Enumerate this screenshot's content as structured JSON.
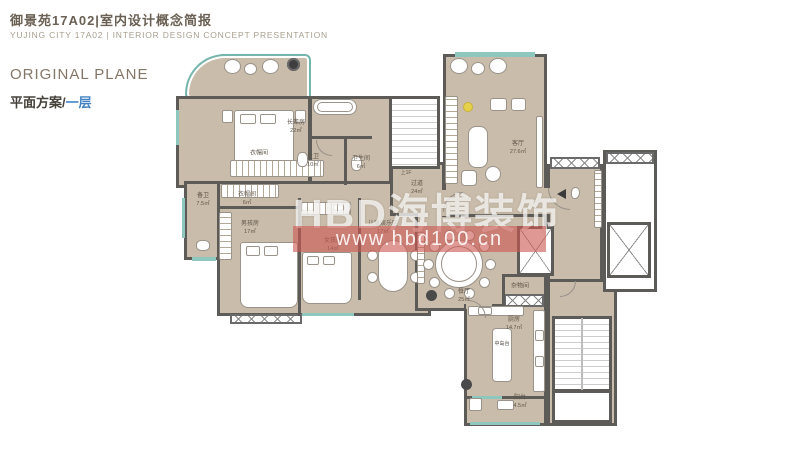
{
  "header": {
    "title": "御景苑17A02|室内设计概念简报",
    "subtitle": "YUJING CITY 17A02 | INTERIOR DESIGN CONCEPT PRESENTATION"
  },
  "section": {
    "title_en": "ORIGINAL PLANE",
    "title_zh": "平面方案/",
    "title_zh_accent": "一层"
  },
  "watermark": {
    "brand": "HBD海博装饰",
    "url": "www.hbd100.cn"
  },
  "plan": {
    "rooms": [
      {
        "name": "长辈房",
        "area": "22㎡"
      },
      {
        "name": "衣帽间",
        "area": ""
      },
      {
        "name": "主卫",
        "area": "10㎡"
      },
      {
        "name": "卫生间",
        "area": "6㎡"
      },
      {
        "name": "备卫",
        "area": "7.5㎡"
      },
      {
        "name": "衣帽间",
        "area": "6㎡"
      },
      {
        "name": "男孩房",
        "area": "17㎡"
      },
      {
        "name": "女孩房",
        "area": "14㎡"
      },
      {
        "name": "儿童娱乐区",
        "area": "17㎡"
      },
      {
        "name": "过道",
        "area": "24㎡"
      },
      {
        "name": "客厅",
        "area": "27.6㎡"
      },
      {
        "name": "餐厅",
        "area": "25㎡"
      },
      {
        "name": "杂物间",
        "area": ""
      },
      {
        "name": "厨房",
        "area": "14.7㎡"
      },
      {
        "name": "阳台",
        "area": "4.5㎡"
      }
    ],
    "annotations": {
      "stair_up": "上1F",
      "island": "中岛台"
    },
    "colors": {
      "wall": "#5d5b58",
      "floor": "#c9bcaa",
      "window_teal": "#8ec7bd",
      "accent_blue": "#4584c4",
      "watermark_red": "#cd5a55"
    }
  }
}
